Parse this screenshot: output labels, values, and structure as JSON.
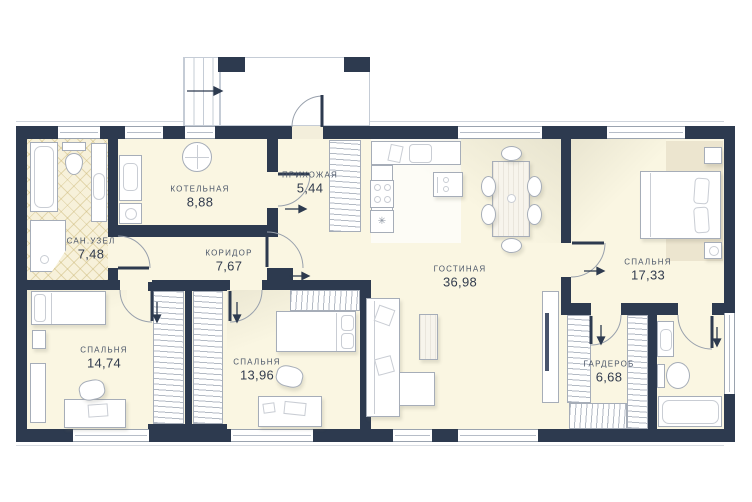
{
  "meta": {
    "title": "План этажа",
    "type": "floor-plan",
    "units": "m2"
  },
  "colors": {
    "wall": "#2d3a4f",
    "floor": "#faf6e2",
    "tile": "#f7f1da",
    "rug": "#ece5cf",
    "outline": "#a6adb8",
    "text": "#4a5568"
  },
  "rooms": [
    {
      "id": "boiler-room",
      "name": "КОТЕЛЬНАЯ",
      "area": "8,88"
    },
    {
      "id": "entrance-hall",
      "name": "ПРИХОЖАЯ",
      "area": "5,44"
    },
    {
      "id": "bathroom",
      "name": "САН.УЗЕЛ",
      "area": "7,48"
    },
    {
      "id": "corridor",
      "name": "КОРИДОР",
      "area": "7,67"
    },
    {
      "id": "living-room",
      "name": "ГОСТИНАЯ",
      "area": "36,98"
    },
    {
      "id": "bedroom-right",
      "name": "СПАЛЬНЯ",
      "area": "17,33"
    },
    {
      "id": "bedroom-left",
      "name": "СПАЛЬНЯ",
      "area": "14,74"
    },
    {
      "id": "bedroom-middle",
      "name": "СПАЛЬНЯ",
      "area": "13,96"
    },
    {
      "id": "wardrobe-room",
      "name": "ГАРДЕРОБ",
      "area": "6,68"
    }
  ]
}
